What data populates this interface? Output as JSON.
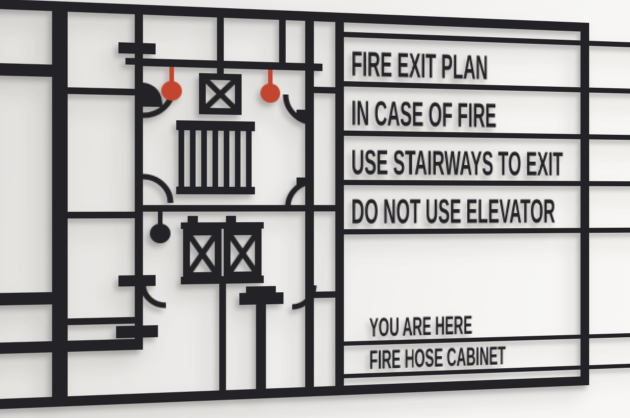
{
  "colors": {
    "sign_black": "#232226",
    "accent_red": "#c2452f",
    "wall_light": "#f6f5f3",
    "wall_mid": "#edecea",
    "wall_dark": "#e2e1de"
  },
  "sign": {
    "messages": [
      "FIRE EXIT PLAN",
      "IN CASE OF FIRE",
      "USE STAIRWAYS TO EXIT",
      "DO NOT USE ELEVATOR"
    ],
    "legend": [
      {
        "label": "YOU ARE HERE",
        "marker": "you-are-here-pin",
        "marker_color": "#232226"
      },
      {
        "label": "FIRE HOSE CABINET",
        "marker": "fire-hose-pin",
        "marker_color": "#c2452f"
      }
    ],
    "plan_symbols": {
      "stairway": "stairway-stripes",
      "elevator": "elevator-x-box",
      "fire_hose": "red-pin",
      "you_are_here": "black-pin"
    }
  }
}
